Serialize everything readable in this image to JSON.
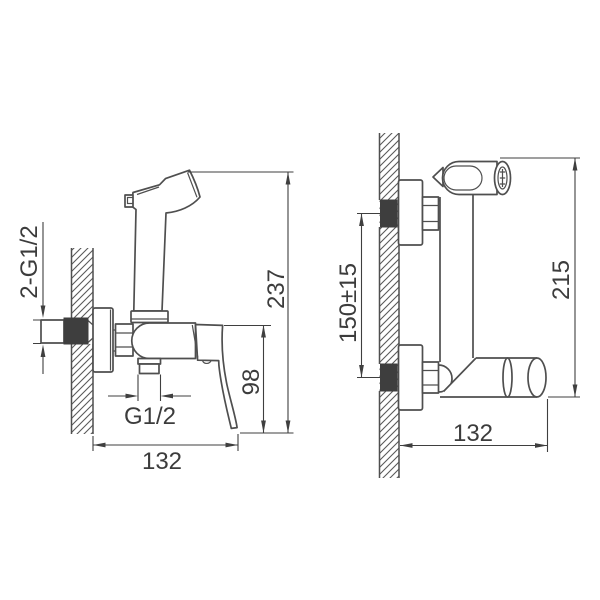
{
  "drawing_type": "wall-mounted bidet shower mixer installation diagram",
  "colors": {
    "line": "#4f4f4f",
    "dim_line": "#3f3f3f",
    "solid_fill": "#3e3e3e",
    "hatch": "#5a5a5a",
    "background": "#ffffff"
  },
  "left_view": {
    "labels": {
      "connection_thread": "2-G1/2",
      "outlet_thread": "G1/2",
      "overall_depth": "132",
      "body_to_handle_tip_height": "98",
      "overall_height": "237"
    }
  },
  "right_view": {
    "labels": {
      "inlet_spacing": "150±15",
      "overall_height": "215",
      "overall_depth": "132"
    }
  }
}
